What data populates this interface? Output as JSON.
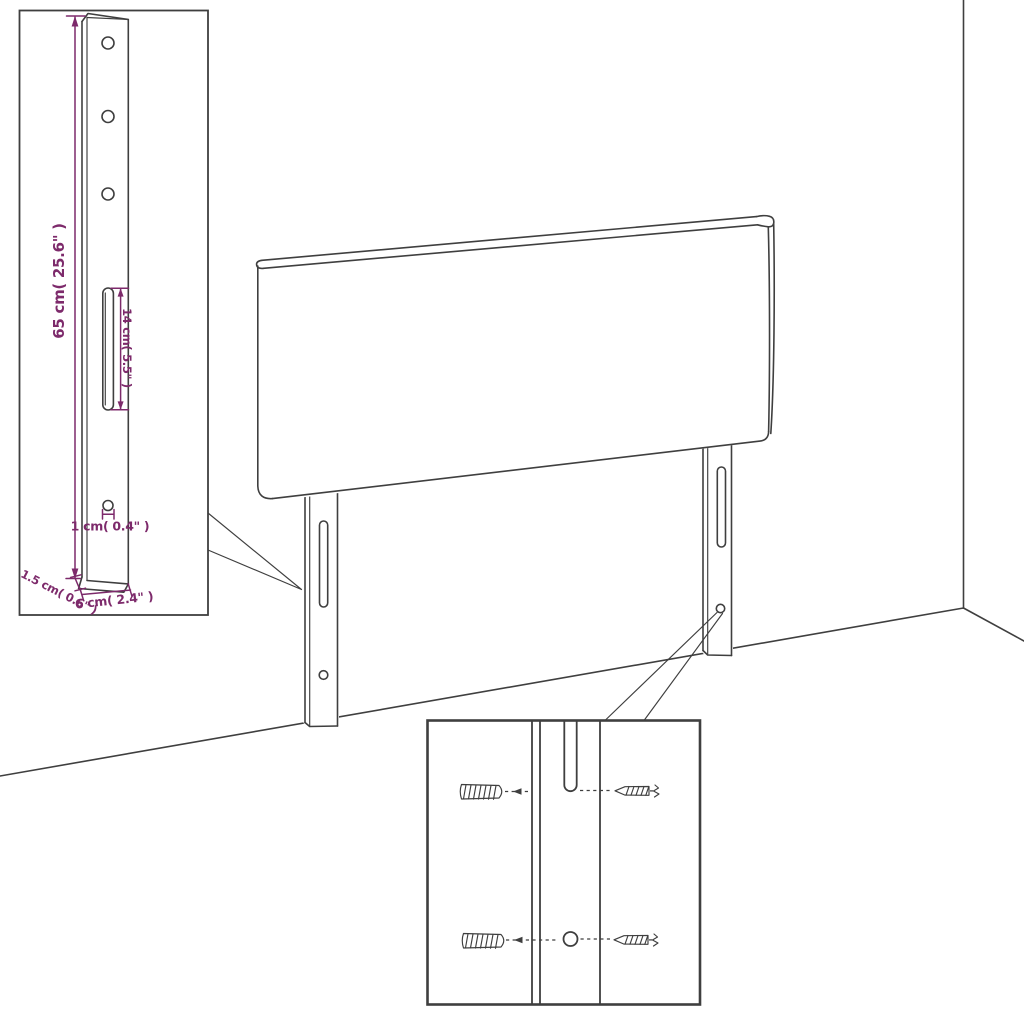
{
  "meta": {
    "figure_type": "product-assembly-dimension-diagram",
    "subject": "headboard-with-mounting-legs"
  },
  "colors": {
    "background": "#ffffff",
    "line": "#3f3f3f",
    "dimension": "#7d2a6b"
  },
  "dimension_labels": {
    "bracket_height": "65 cm( 25.6\" )",
    "slot_length": "14 cm( 5.5\" )",
    "hole_diameter": "1 cm( 0.4\" )",
    "bracket_thickness": "1.5 cm( 0.6\" )",
    "bracket_width": "6 cm( 2.4\" )"
  },
  "icons": {
    "hardware": [
      "wall-plug-icon",
      "screw-icon"
    ],
    "drawing": [
      "headboard-panel",
      "mounting-leg",
      "keyhole-slot",
      "screw-hole"
    ]
  }
}
